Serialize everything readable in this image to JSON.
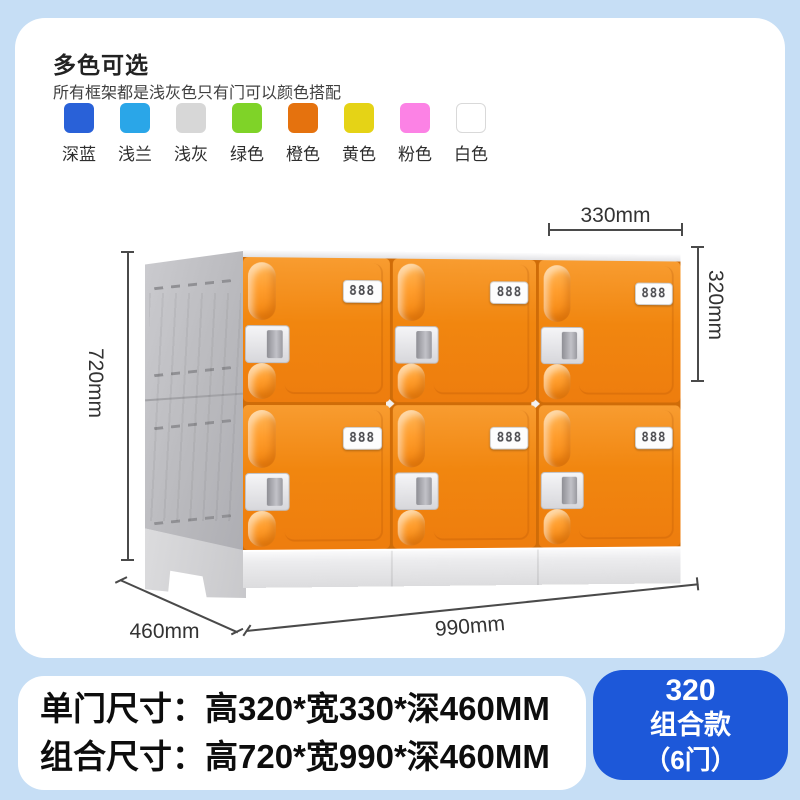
{
  "page": {
    "bg": "#c6def5"
  },
  "colors_section": {
    "title": "多色可选",
    "subtitle": "所有框架都是浅灰色只有门可以颜色搭配",
    "swatches": [
      {
        "label": "深蓝",
        "color": "#2961d8"
      },
      {
        "label": "浅兰",
        "color": "#2aa6e8"
      },
      {
        "label": "浅灰",
        "color": "#d7d7d7"
      },
      {
        "label": "绿色",
        "color": "#7fd328"
      },
      {
        "label": "橙色",
        "color": "#e5720e"
      },
      {
        "label": "黄色",
        "color": "#e5d316"
      },
      {
        "label": "粉色",
        "color": "#fc82e5"
      },
      {
        "label": "白色",
        "color": "#ffffff"
      }
    ]
  },
  "diagram": {
    "door_count": 6,
    "lock_label": "888",
    "door_color": "#ee7d0e",
    "dims": {
      "door_width": "330mm",
      "door_height": "320mm",
      "total_height": "720mm",
      "depth": "460mm",
      "total_width": "990mm"
    }
  },
  "specs": {
    "line1": "单门尺寸：高320*宽330*深460MM",
    "line2": "组合尺寸：高720*宽990*深460MM"
  },
  "badge": {
    "line1": "320",
    "line2": "组合款",
    "line3": "（6门）",
    "color": "#1d58d9"
  }
}
